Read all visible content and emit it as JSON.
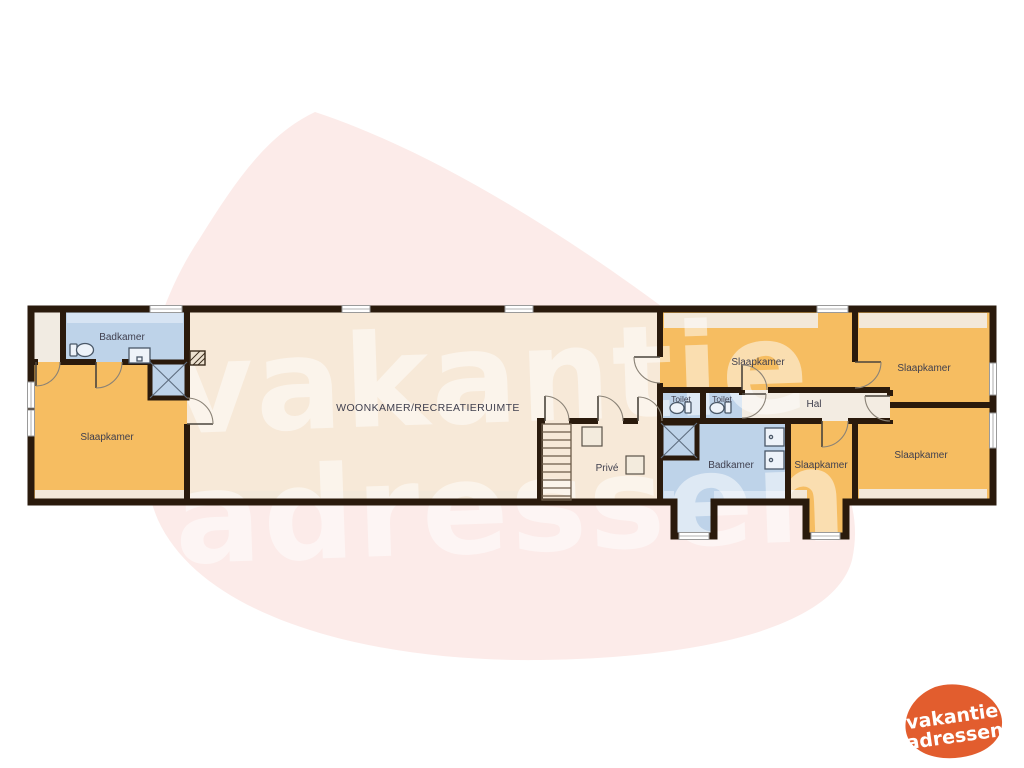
{
  "watermark": {
    "line1": "vakantie",
    "line2": "adressen"
  },
  "logo": {
    "line1": "vakantie",
    "line2": "adressen",
    "color": "#e25d2e"
  },
  "floorplan": {
    "colors": {
      "wall": "#2a1a0c",
      "floor_cream": "#f7e9d8",
      "hal_floor": "#f3ece2",
      "closet_floor": "#f1ebe2",
      "bedroom_orange": "#f6bd61",
      "bath_blue": "#bed3e9",
      "band_cream": "#f3e8d9",
      "band_blue": "#d7e4f3",
      "background_blob": "#fcebe9",
      "label_text": "#3f3f4e"
    },
    "labels": {
      "badkamer_left": "Badkamer",
      "slaapkamer_left": "Slaapkamer",
      "woonkamer": "WOONKAMER/RECREATIERUIMTE",
      "prive": "Privé",
      "toilet_1": "Toilet",
      "toilet_2": "Toilet",
      "slaapkamer_mid_top": "Slaapkamer",
      "hal": "Hal",
      "badkamer_right": "Badkamer",
      "slaapkamer_mid_bottom": "Slaapkamer",
      "slaapkamer_right_top": "Slaapkamer",
      "slaapkamer_right_bottom": "Slaapkamer"
    }
  }
}
